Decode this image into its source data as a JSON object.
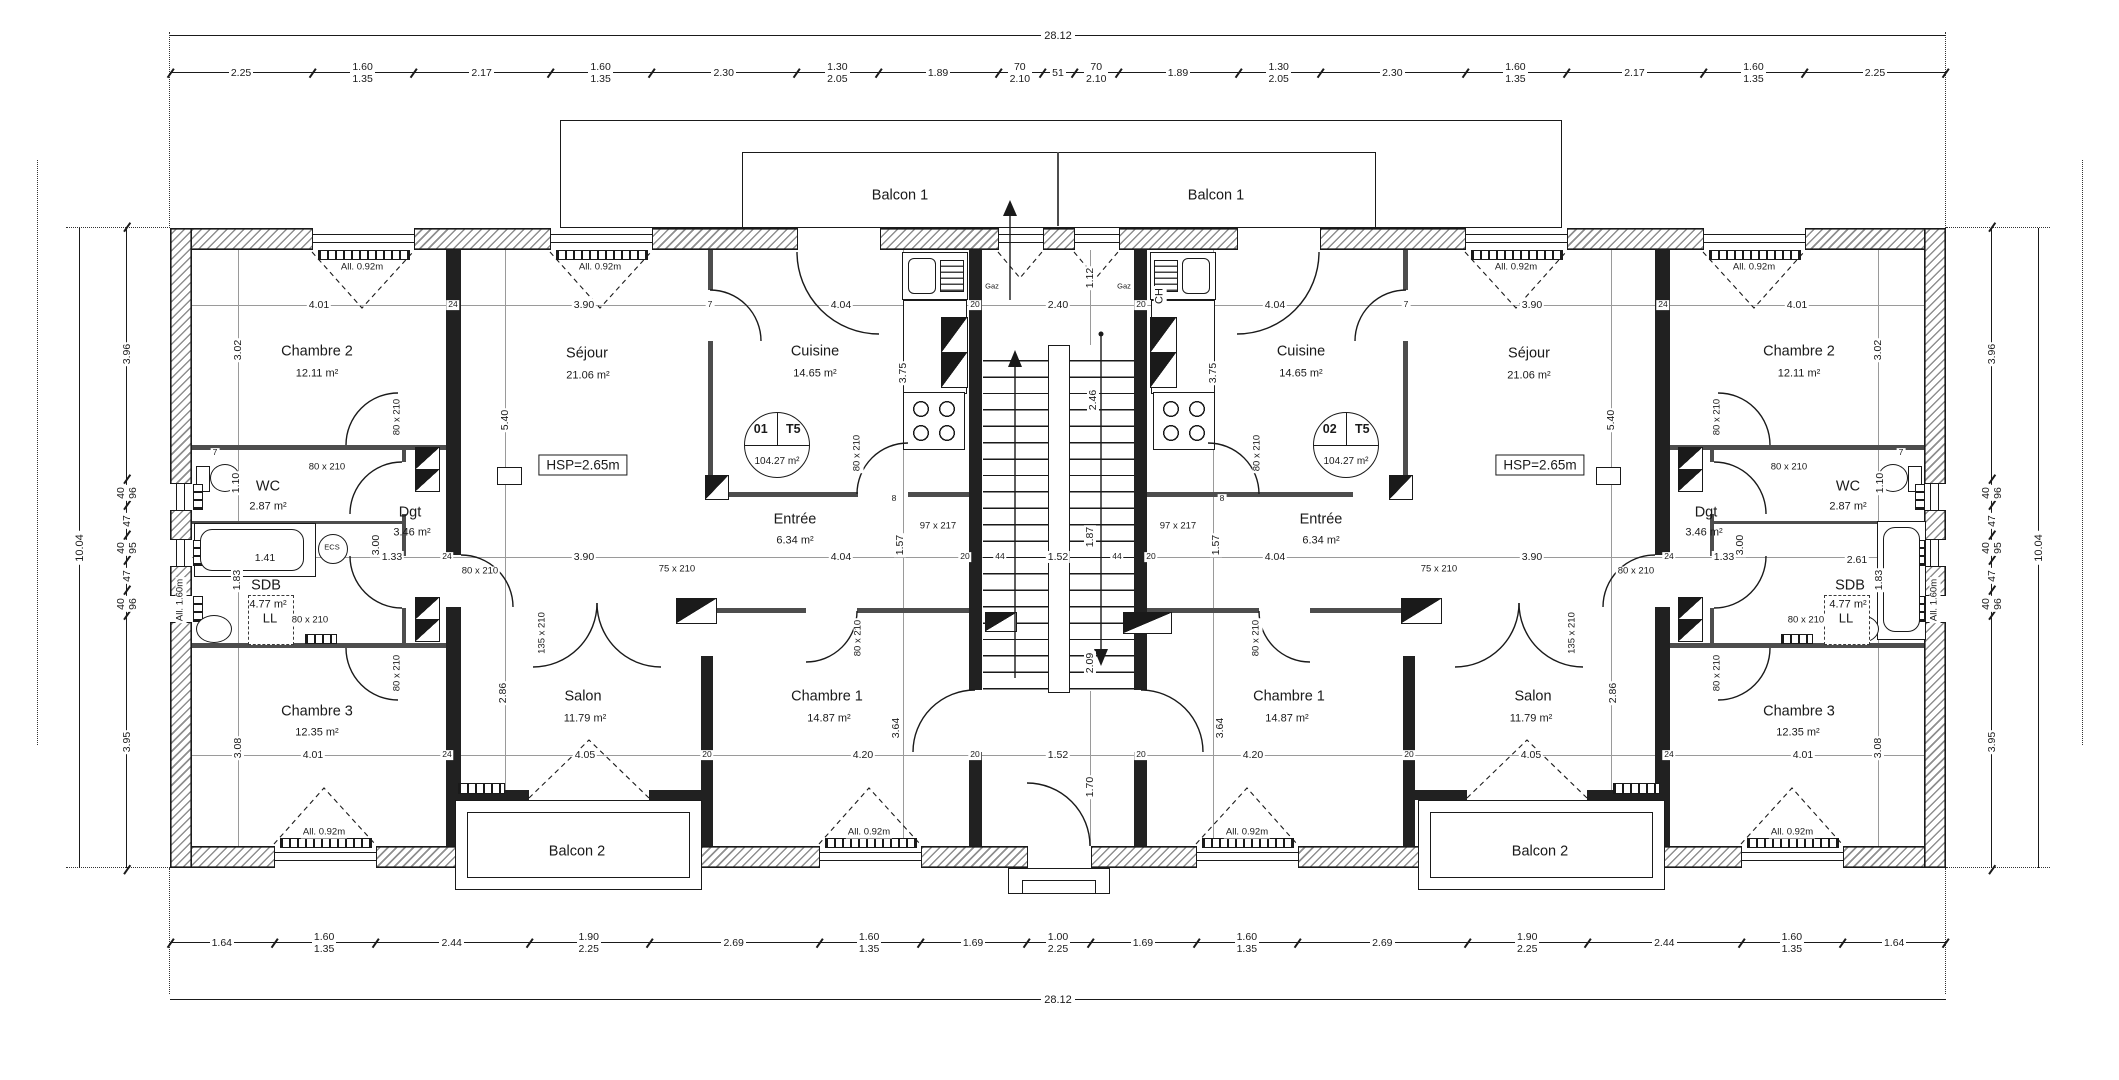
{
  "plan": {
    "unit_left": {
      "num": "01",
      "type": "T5",
      "area": "104.27 m²"
    },
    "unit_right": {
      "num": "02",
      "type": "T5",
      "area": "104.27 m²"
    },
    "labels": {
      "balcon1": "Balcon 1",
      "balcon2": "Balcon 2",
      "hsp": "HSP=2.65m",
      "ch": "CH",
      "gaz": "Gaz",
      "ecs": "ECS",
      "ll": "LL",
      "allege_092": "All. 0.92m",
      "allege_160": "All. 1.60m"
    },
    "rooms": {
      "chambre2": {
        "name": "Chambre 2",
        "area": "12.11 m²"
      },
      "sejour": {
        "name": "Séjour",
        "area": "21.06 m²"
      },
      "cuisine": {
        "name": "Cuisine",
        "area": "14.65 m²"
      },
      "wc": {
        "name": "WC",
        "area": "2.87 m²"
      },
      "sdb": {
        "name": "SDB",
        "area": "4.77 m²"
      },
      "dgt": {
        "name": "Dgt",
        "area": "3.46 m²"
      },
      "entree": {
        "name": "Entrée",
        "area": "6.34 m²"
      },
      "chambre3": {
        "name": "Chambre 3",
        "area": "12.35 m²"
      },
      "salon": {
        "name": "Salon",
        "area": "11.79 m²"
      },
      "chambre1": {
        "name": "Chambre 1",
        "area": "14.87 m²"
      }
    },
    "doors": {
      "d80": "80 x 210",
      "d75": "75 x 210",
      "d97": "97 x 217",
      "d135": "135 x 210"
    },
    "dims": {
      "top_total": "28.12",
      "bottom_total": "28.12",
      "side_total": "10.04",
      "top": [
        {
          "a": "2.25"
        },
        {
          "a": "1.60",
          "b": "1.35"
        },
        {
          "a": "2.17"
        },
        {
          "a": "1.60",
          "b": "1.35"
        },
        {
          "a": "2.30"
        },
        {
          "a": "1.30",
          "b": "2.05"
        },
        {
          "a": "1.89"
        },
        {
          "a": "70",
          "b": "2.10"
        },
        {
          "a": "51"
        },
        {
          "a": "70",
          "b": "2.10"
        },
        {
          "a": "1.89"
        },
        {
          "a": "1.30",
          "b": "2.05"
        },
        {
          "a": "2.30"
        },
        {
          "a": "1.60",
          "b": "1.35"
        },
        {
          "a": "2.17"
        },
        {
          "a": "1.60",
          "b": "1.35"
        },
        {
          "a": "2.25"
        }
      ],
      "bottom": [
        {
          "a": "1.64"
        },
        {
          "a": "1.60",
          "b": "1.35"
        },
        {
          "a": "2.44"
        },
        {
          "a": "1.90",
          "b": "2.25"
        },
        {
          "a": "2.69"
        },
        {
          "a": "1.60",
          "b": "1.35"
        },
        {
          "a": "1.69"
        },
        {
          "a": "1.00",
          "b": "2.25"
        },
        {
          "a": "1.69"
        },
        {
          "a": "1.60",
          "b": "1.35"
        },
        {
          "a": "2.69"
        },
        {
          "a": "1.90",
          "b": "2.25"
        },
        {
          "a": "2.44"
        },
        {
          "a": "1.60",
          "b": "1.35"
        },
        {
          "a": "1.64"
        }
      ],
      "side": [
        {
          "a": "3.96"
        },
        {
          "a": "40",
          "b": "96"
        },
        {
          "a": "47"
        },
        {
          "a": "40",
          "b": "95"
        },
        {
          "a": "47"
        },
        {
          "a": "40",
          "b": "96"
        },
        {
          "a": "3.95"
        }
      ],
      "inner": {
        "c2w": "4.01",
        "w24": "24",
        "sejw": "3.90",
        "p7": "7",
        "cuiw": "4.04",
        "w20": "20",
        "stw": "2.40",
        "v112": "1.12",
        "c2h": "3.02",
        "sejh": "5.40",
        "cuih": "3.75",
        "v246": "2.46",
        "v187": "1.87",
        "v209": "2.09",
        "v170": "1.70",
        "h152": "1.52",
        "n44": "44",
        "v157": "1.57",
        "wc110": "1.10",
        "d300": "3.00",
        "d133": "1.33",
        "sdb183": "1.83",
        "t141": "1.41",
        "t261": "2.61",
        "c3h": "3.08",
        "salh": "2.86",
        "sal405": "4.05",
        "c1h": "3.64",
        "c1w": "4.20",
        "n8": "8"
      }
    }
  }
}
